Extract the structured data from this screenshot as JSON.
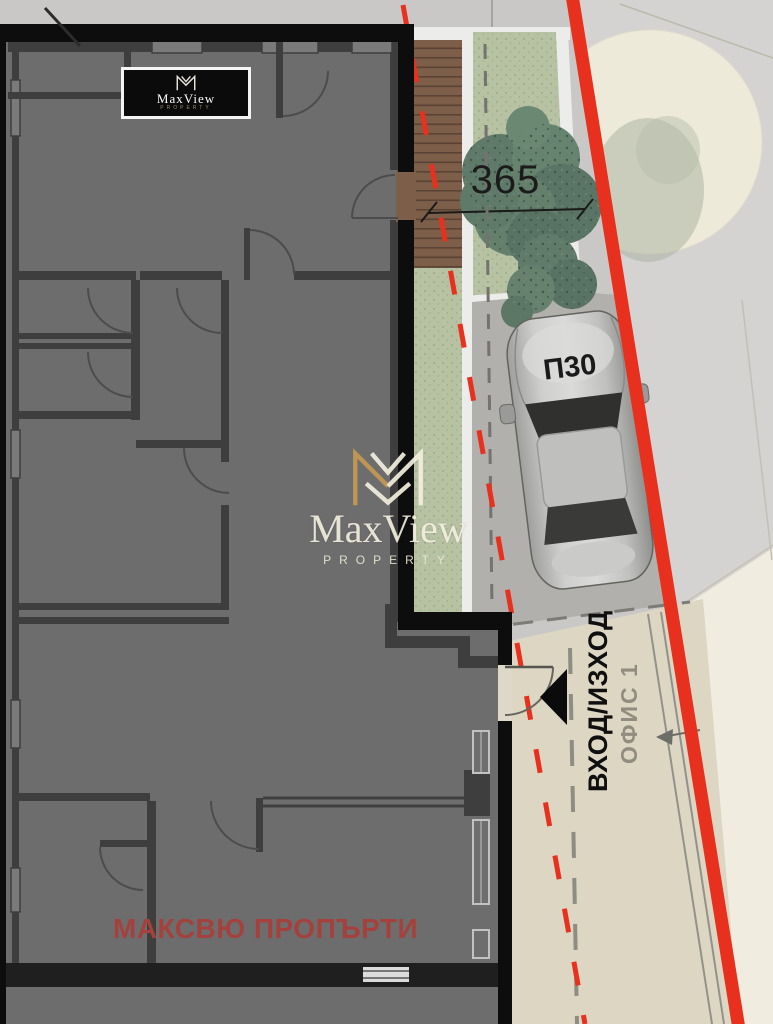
{
  "site_plan": {
    "logo": {
      "brand": "MaxView",
      "sub": "PROPERTY"
    },
    "watermark": {
      "brand": "MaxView",
      "sub": "PROPERTY"
    },
    "labels": {
      "dimension": "365",
      "parking_spot": "П30",
      "entrance": "ВХОД/ИЗХОД",
      "office": "ОФИС 1",
      "footer_brand": "МАКСВЮ ПРОПЪРТИ"
    },
    "colors": {
      "boundary_red": "#e8301f",
      "footer_text_red": "#a5413d",
      "plan_floor_gray": "#6d6d6d",
      "wall_dark": "#3e3e3e",
      "outer_wall_black": "#0d0d0d",
      "street_gray": "#c9c8c6",
      "parking_gray": "#b2b0ad",
      "sidewalk_beige": "#dcd6c3",
      "pale_cream": "#f0ede0",
      "lawn_green": "#b7c2a3",
      "bush_green": "#5f7a68",
      "deck_brown": "#7c5e49",
      "logo_gold": "#c49a52"
    }
  }
}
